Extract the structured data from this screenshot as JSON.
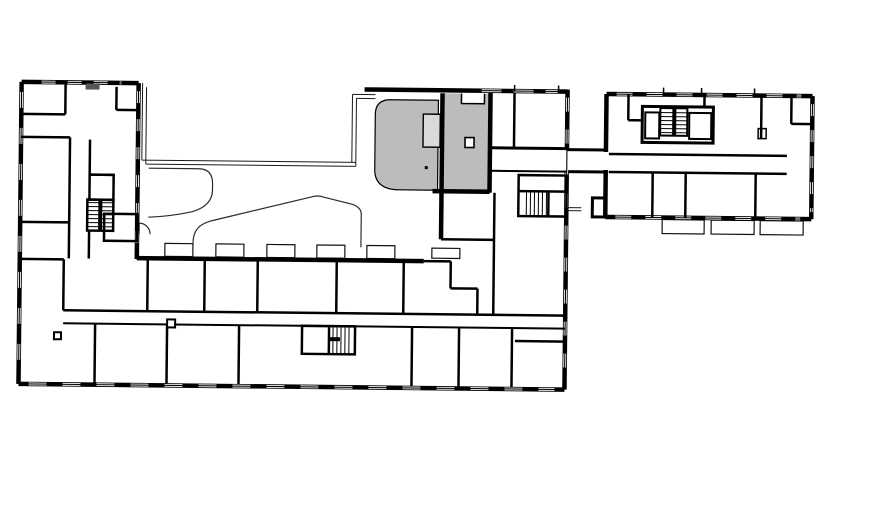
{
  "title": "floor-plan",
  "colors": {
    "background": "#ffffff",
    "wall": "#000000",
    "highlight_fill": "#bcbcbc",
    "recess_fill": "#d9d9d9",
    "landscape_line": "#2b2b2b"
  },
  "plan": {
    "highlighted_unit": "selected-unit",
    "buildings": [
      "main-building",
      "annex-building"
    ],
    "stairwells": [
      "west-wing-stair",
      "south-wing-stair",
      "east-core-stair",
      "annex-core-stair"
    ],
    "features": [
      "courtyard",
      "terrace-outline",
      "connector-corridor"
    ],
    "balconies": {
      "courtyard": 6,
      "annex": 3
    }
  }
}
